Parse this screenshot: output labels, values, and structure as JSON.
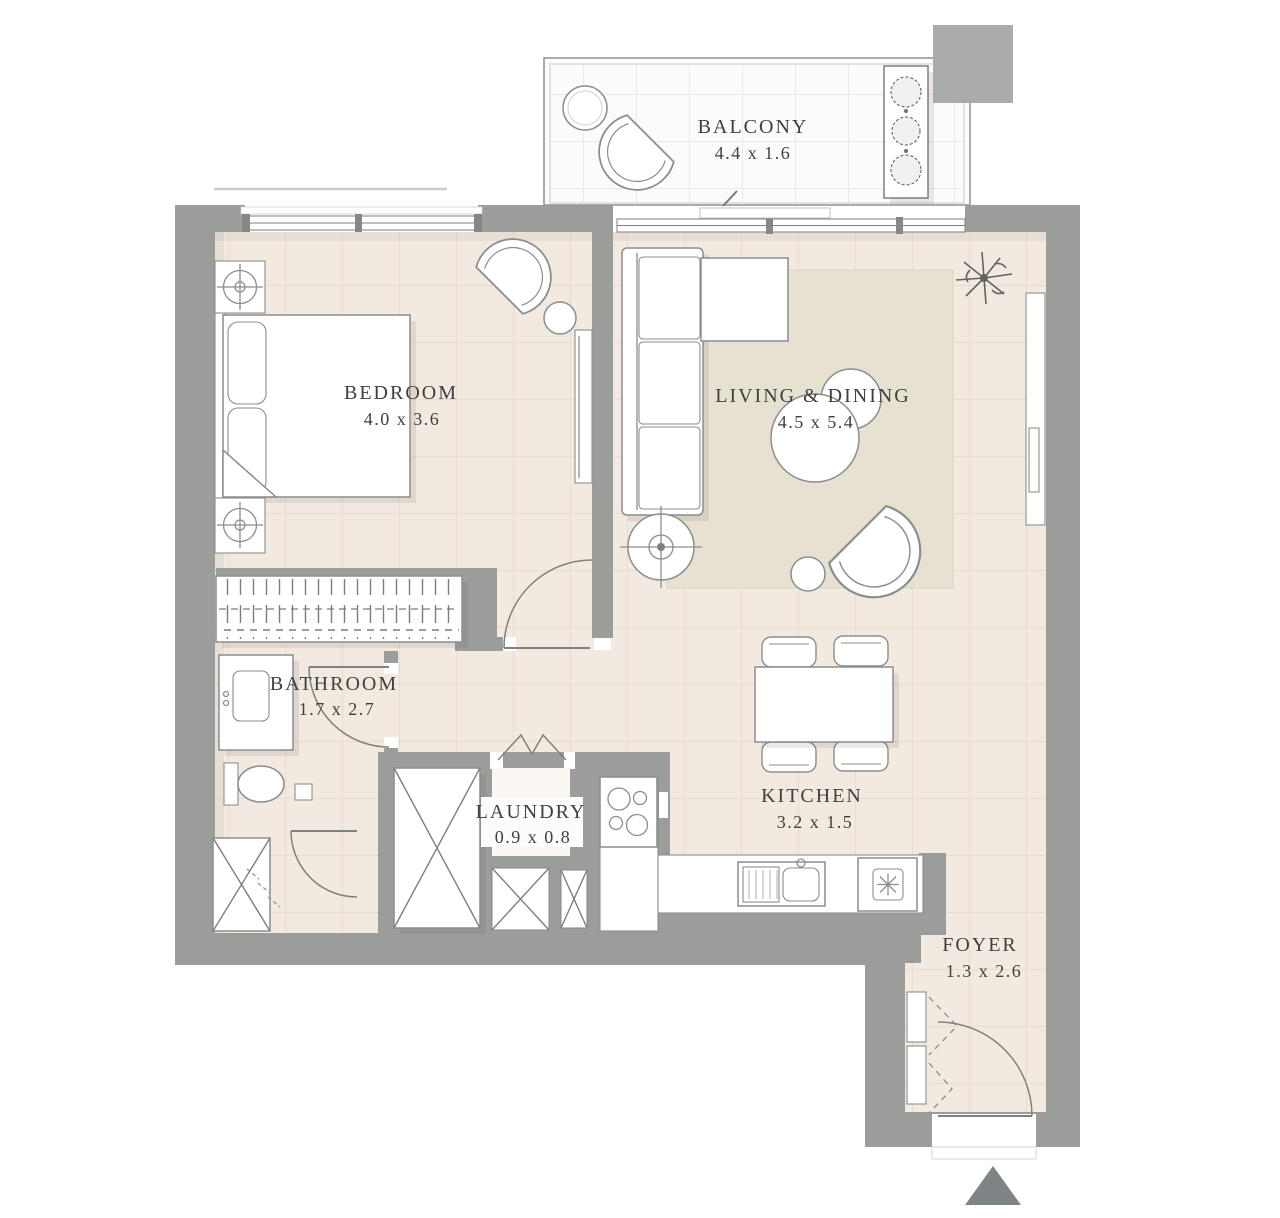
{
  "plan": {
    "rooms": [
      {
        "id": "balcony",
        "name": "BALCONY",
        "dimensions": "4.4 x 1.6"
      },
      {
        "id": "bedroom",
        "name": "BEDROOM",
        "dimensions": "4.0 x 3.6"
      },
      {
        "id": "living_dining",
        "name": "LIVING & DINING",
        "dimensions": "4.5 x 5.4"
      },
      {
        "id": "bathroom",
        "name": "BATHROOM",
        "dimensions": "1.7 x 2.7"
      },
      {
        "id": "laundry",
        "name": "LAUNDRY",
        "dimensions": "0.9 x 0.8"
      },
      {
        "id": "kitchen",
        "name": "KITCHEN",
        "dimensions": "3.2 x 1.5"
      },
      {
        "id": "foyer",
        "name": "FOYER",
        "dimensions": "1.3 x 2.6"
      }
    ],
    "colors": {
      "wall": "#9b9d9b",
      "corner_block": "#aaacaa",
      "floor": "#f2eae0",
      "floor_grid": "#ddcdbf",
      "balcony_floor": "#fbfbfb",
      "rug": "#e7e1d2",
      "furniture_stroke": "#8b8e8c",
      "text": "#3f3f3d",
      "north_arrow": "#7f8486"
    },
    "icons": [
      "north-arrow-icon",
      "plant-icon",
      "lamp-icon",
      "shaft-x-icon"
    ]
  }
}
